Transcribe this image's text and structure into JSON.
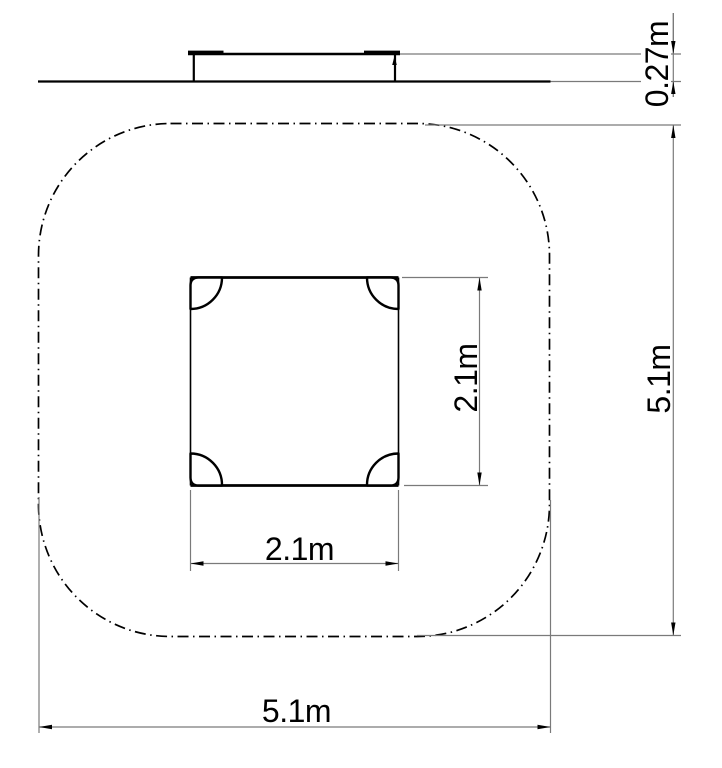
{
  "drawing": {
    "type": "cad-technical-drawing",
    "views": {
      "side_view": {
        "description": "platform side elevation",
        "height_dimension": {
          "label": "0.27m",
          "value_m": 0.27,
          "orientation": "vertical"
        }
      },
      "plan_view": {
        "description": "square platform with four corner posts inside rounded-square safety zone",
        "platform_depth_dimension": {
          "label": "2.1m",
          "value_m": 2.1,
          "orientation": "vertical"
        },
        "platform_width_dimension": {
          "label": "2.1m",
          "value_m": 2.1,
          "orientation": "horizontal"
        },
        "zone_depth_dimension": {
          "label": "5.1m",
          "value_m": 5.1,
          "orientation": "vertical"
        },
        "zone_width_dimension": {
          "label": "5.1m",
          "value_m": 5.1,
          "orientation": "horizontal"
        }
      }
    },
    "line_styles": {
      "object_color": "#000000",
      "dimension_color": "#7a7a7a",
      "safety_zone_linestyle": "dash-dot",
      "background": "#ffffff"
    }
  }
}
